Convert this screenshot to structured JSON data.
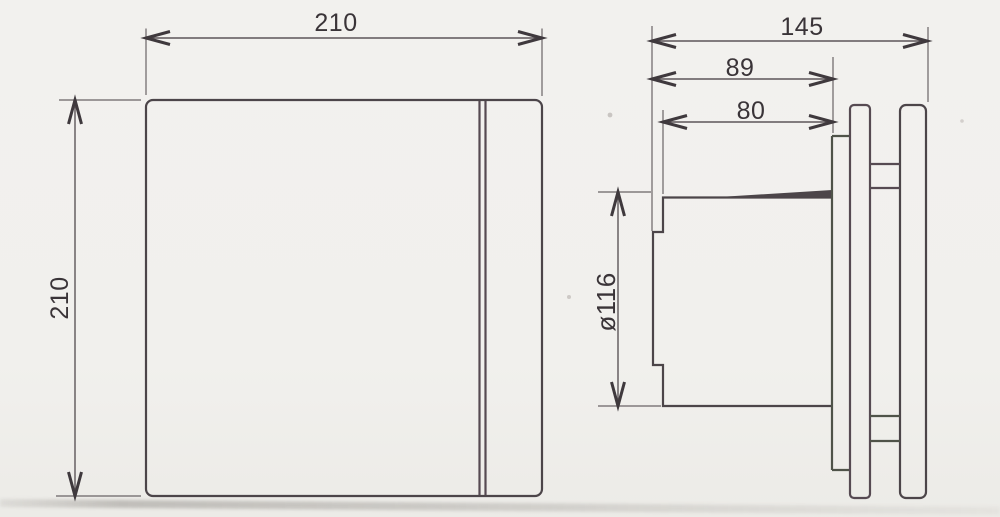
{
  "drawing": {
    "type": "technical-dimension-diagram",
    "labels": {
      "front_width": "210",
      "front_height": "210",
      "side_total_depth": "145",
      "side_body_depth": "89",
      "side_spigot_length": "80",
      "side_spigot_diameter": "ø116"
    },
    "colors": {
      "background": "#f1f0ed",
      "line": "#4c4549",
      "dimension_line": "#5d5659",
      "label_text": "#3a3438"
    }
  }
}
